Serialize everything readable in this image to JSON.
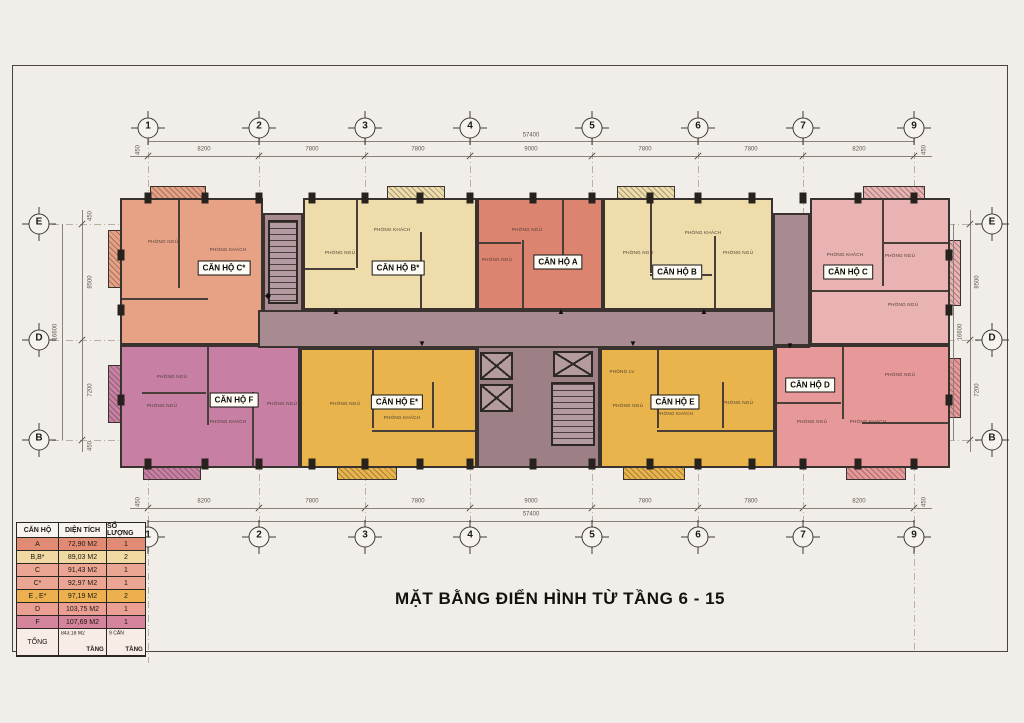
{
  "title": "MẶT BẰNG ĐIỂN HÌNH TỪ TẦNG 6 - 15",
  "colors": {
    "paper": "#f1eee9",
    "frame": "#4a4440",
    "wall": "#3a322e",
    "corridor": "#a78b90",
    "core": "#9d8086",
    "gridline": "#b7b0a6"
  },
  "grid": {
    "top_labels": [
      "1",
      "2",
      "3",
      "4",
      "5",
      "6",
      "7",
      "9"
    ],
    "x_positions": [
      148,
      259,
      365,
      470,
      592,
      698,
      803,
      914
    ],
    "segment_dims": [
      "8200",
      "7800",
      "7800",
      "9000",
      "7800",
      "7800",
      "8200"
    ],
    "overall_dim": "57400",
    "end_dim": "450",
    "side_labels": [
      "E",
      "D",
      "B"
    ],
    "y_positions": [
      224,
      340,
      440
    ],
    "side_segment_dims": [
      "8500",
      "7200"
    ],
    "side_overall_dim": "16600"
  },
  "plan": {
    "corridor": {
      "x": 258,
      "y": 310,
      "w": 552,
      "h": 38
    },
    "left_shaft": {
      "x": 263,
      "y": 213,
      "w": 40,
      "h": 99
    },
    "right_shaft": {
      "x": 773,
      "y": 213,
      "w": 37,
      "h": 133
    },
    "core": {
      "x": 477,
      "y": 346,
      "w": 123,
      "h": 122
    },
    "left_stair": {
      "x": 268,
      "y": 220,
      "w": 30,
      "h": 84
    },
    "core_stair": {
      "x": 551,
      "y": 382,
      "w": 44,
      "h": 64
    },
    "elevators": [
      {
        "x": 480,
        "y": 352,
        "w": 33,
        "h": 28
      },
      {
        "x": 480,
        "y": 384,
        "w": 33,
        "h": 28
      },
      {
        "x": 553,
        "y": 351,
        "w": 40,
        "h": 26
      }
    ],
    "units": [
      {
        "id": "c-star",
        "label": "CĂN HỘ C*",
        "color": "#e7a286",
        "x": 120,
        "y": 198,
        "w": 143,
        "h": 147,
        "lx": 224,
        "ly": 268,
        "rooms": [
          {
            "t": "PHÒNG NGỦ",
            "x": 163,
            "y": 242
          },
          {
            "t": "PHÒNG KHÁCH",
            "x": 228,
            "y": 250
          }
        ]
      },
      {
        "id": "b-star",
        "label": "CĂN HỘ B*",
        "color": "#eeddab",
        "x": 303,
        "y": 198,
        "w": 174,
        "h": 112,
        "lx": 398,
        "ly": 268,
        "rooms": [
          {
            "t": "PHÒNG NGỦ",
            "x": 340,
            "y": 253
          },
          {
            "t": "PHÒNG KHÁCH",
            "x": 392,
            "y": 230
          }
        ]
      },
      {
        "id": "a",
        "label": "CĂN HỘ A",
        "color": "#dd8471",
        "x": 477,
        "y": 198,
        "w": 126,
        "h": 112,
        "lx": 558,
        "ly": 262,
        "rooms": [
          {
            "t": "PHÒNG NGỦ",
            "x": 527,
            "y": 230
          },
          {
            "t": "PHÒNG NGỦ",
            "x": 497,
            "y": 260
          }
        ]
      },
      {
        "id": "b",
        "label": "CĂN HỘ B",
        "color": "#eeddab",
        "x": 603,
        "y": 198,
        "w": 170,
        "h": 112,
        "lx": 677,
        "ly": 272,
        "rooms": [
          {
            "t": "PHÒNG KHÁCH",
            "x": 703,
            "y": 233
          },
          {
            "t": "PHÒNG NGỦ",
            "x": 638,
            "y": 253
          },
          {
            "t": "PHÒNG NGỦ",
            "x": 738,
            "y": 253
          }
        ]
      },
      {
        "id": "c",
        "label": "CĂN HỘ C",
        "color": "#e8b3b2",
        "x": 810,
        "y": 198,
        "w": 140,
        "h": 147,
        "lx": 848,
        "ly": 272,
        "rooms": [
          {
            "t": "PHÒNG KHÁCH",
            "x": 845,
            "y": 255
          },
          {
            "t": "PHÒNG NGỦ",
            "x": 900,
            "y": 256
          },
          {
            "t": "PHÒNG NGỦ",
            "x": 903,
            "y": 305
          }
        ]
      },
      {
        "id": "f",
        "label": "CĂN HỘ F",
        "color": "#c77fa4",
        "x": 120,
        "y": 345,
        "w": 180,
        "h": 123,
        "lx": 234,
        "ly": 400,
        "rooms": [
          {
            "t": "PHÒNG NGỦ",
            "x": 172,
            "y": 377
          },
          {
            "t": "PHÒNG NGỦ",
            "x": 162,
            "y": 406
          },
          {
            "t": "PHÒNG KHÁCH",
            "x": 228,
            "y": 422
          },
          {
            "t": "PHÒNG NGỦ",
            "x": 282,
            "y": 404
          }
        ]
      },
      {
        "id": "e-star",
        "label": "CĂN HỘ E*",
        "color": "#e9b44b",
        "x": 300,
        "y": 348,
        "w": 177,
        "h": 120,
        "lx": 397,
        "ly": 402,
        "rooms": [
          {
            "t": "PHÒNG NGỦ",
            "x": 345,
            "y": 404
          },
          {
            "t": "PHÒNG KHÁCH",
            "x": 402,
            "y": 418
          }
        ]
      },
      {
        "id": "e",
        "label": "CĂN HỘ E",
        "color": "#e9b44b",
        "x": 600,
        "y": 348,
        "w": 175,
        "h": 120,
        "lx": 675,
        "ly": 402,
        "rooms": [
          {
            "t": "PHÒNG LV",
            "x": 622,
            "y": 372
          },
          {
            "t": "PHÒNG NGỦ",
            "x": 628,
            "y": 406
          },
          {
            "t": "PHÒNG KHÁCH",
            "x": 675,
            "y": 414
          },
          {
            "t": "PHÒNG NGỦ",
            "x": 738,
            "y": 403
          }
        ]
      },
      {
        "id": "d",
        "label": "CĂN HỘ D",
        "color": "#e79899",
        "x": 775,
        "y": 345,
        "w": 175,
        "h": 123,
        "lx": 810,
        "ly": 385,
        "rooms": [
          {
            "t": "PHÒNG NGỦ",
            "x": 812,
            "y": 422
          },
          {
            "t": "PHÒNG KHÁCH",
            "x": 868,
            "y": 422
          },
          {
            "t": "PHÒNG NGỦ",
            "x": 900,
            "y": 375
          }
        ]
      }
    ],
    "balconies_top": [
      {
        "x": 150,
        "w": 56,
        "c": "#e7a286"
      },
      {
        "x": 387,
        "w": 58,
        "c": "#eeddab"
      },
      {
        "x": 617,
        "w": 58,
        "c": "#eeddab"
      },
      {
        "x": 863,
        "w": 62,
        "c": "#e8b3b2"
      }
    ],
    "balconies_bottom": [
      {
        "x": 143,
        "w": 58,
        "c": "#c77fa4"
      },
      {
        "x": 337,
        "w": 60,
        "c": "#e9b44b"
      },
      {
        "x": 623,
        "w": 62,
        "c": "#e9b44b"
      },
      {
        "x": 846,
        "w": 60,
        "c": "#e79899"
      }
    ],
    "balconies_left": [
      {
        "y": 230,
        "h": 58,
        "c": "#e7a286"
      },
      {
        "y": 365,
        "h": 58,
        "c": "#c77fa4"
      }
    ],
    "balconies_right": [
      {
        "y": 240,
        "h": 66,
        "c": "#e8b3b2"
      },
      {
        "y": 358,
        "h": 60,
        "c": "#e79899"
      }
    ],
    "dividers": [
      [
        178,
        200,
        2,
        88
      ],
      [
        122,
        298,
        86,
        2
      ],
      [
        356,
        200,
        2,
        68
      ],
      [
        420,
        232,
        2,
        76
      ],
      [
        305,
        268,
        50,
        2
      ],
      [
        522,
        240,
        2,
        68
      ],
      [
        479,
        242,
        42,
        2
      ],
      [
        562,
        200,
        2,
        58
      ],
      [
        650,
        200,
        2,
        73
      ],
      [
        714,
        236,
        2,
        72
      ],
      [
        650,
        274,
        62,
        2
      ],
      [
        882,
        200,
        2,
        86
      ],
      [
        812,
        290,
        136,
        2
      ],
      [
        884,
        242,
        64,
        2
      ],
      [
        207,
        347,
        2,
        78
      ],
      [
        142,
        392,
        64,
        2
      ],
      [
        252,
        392,
        2,
        74
      ],
      [
        372,
        350,
        2,
        78
      ],
      [
        372,
        430,
        103,
        2
      ],
      [
        432,
        382,
        2,
        46
      ],
      [
        657,
        350,
        2,
        78
      ],
      [
        657,
        430,
        116,
        2
      ],
      [
        722,
        382,
        2,
        46
      ],
      [
        842,
        347,
        2,
        72
      ],
      [
        777,
        402,
        64,
        2
      ],
      [
        862,
        422,
        86,
        2
      ]
    ],
    "column_xs": [
      148,
      205,
      259,
      312,
      365,
      420,
      470,
      533,
      592,
      650,
      698,
      752,
      803,
      858,
      914
    ],
    "arrows": [
      {
        "x": 336,
        "y": 312,
        "g": "▲"
      },
      {
        "x": 561,
        "y": 312,
        "g": "▲"
      },
      {
        "x": 704,
        "y": 312,
        "g": "▲"
      },
      {
        "x": 422,
        "y": 344,
        "g": "▼"
      },
      {
        "x": 633,
        "y": 344,
        "g": "▼"
      },
      {
        "x": 790,
        "y": 346,
        "g": "▼"
      },
      {
        "x": 268,
        "y": 296,
        "g": "◆"
      }
    ]
  },
  "legend_table": {
    "headers": [
      "CĂN HỘ",
      "DIỆN TÍCH",
      "SỐ LƯỢNG"
    ],
    "rows": [
      {
        "unit": "A",
        "area": "72,90 M2",
        "qty": "1",
        "color": "#e18a74"
      },
      {
        "unit": "B,B*",
        "area": "89,03 M2",
        "qty": "2",
        "color": "#f0d9a2"
      },
      {
        "unit": "C",
        "area": "91,43 M2",
        "qty": "1",
        "color": "#eba693"
      },
      {
        "unit": "C*",
        "area": "92,97 M2",
        "qty": "1",
        "color": "#eba693"
      },
      {
        "unit": "E , E*",
        "area": "97,19 M2",
        "qty": "2",
        "color": "#ecb14e"
      },
      {
        "unit": "D",
        "area": "103,75 M2",
        "qty": "1",
        "color": "#ea9f92"
      },
      {
        "unit": "F",
        "area": "107,69 M2",
        "qty": "1",
        "color": "#d4849b"
      }
    ],
    "total": {
      "label": "TỔNG",
      "area_value": "843.18 M2",
      "area_unit": "TẦNG",
      "qty_value": "9 CĂN",
      "qty_unit": "TẦNG",
      "color": "#f8ece6"
    }
  }
}
